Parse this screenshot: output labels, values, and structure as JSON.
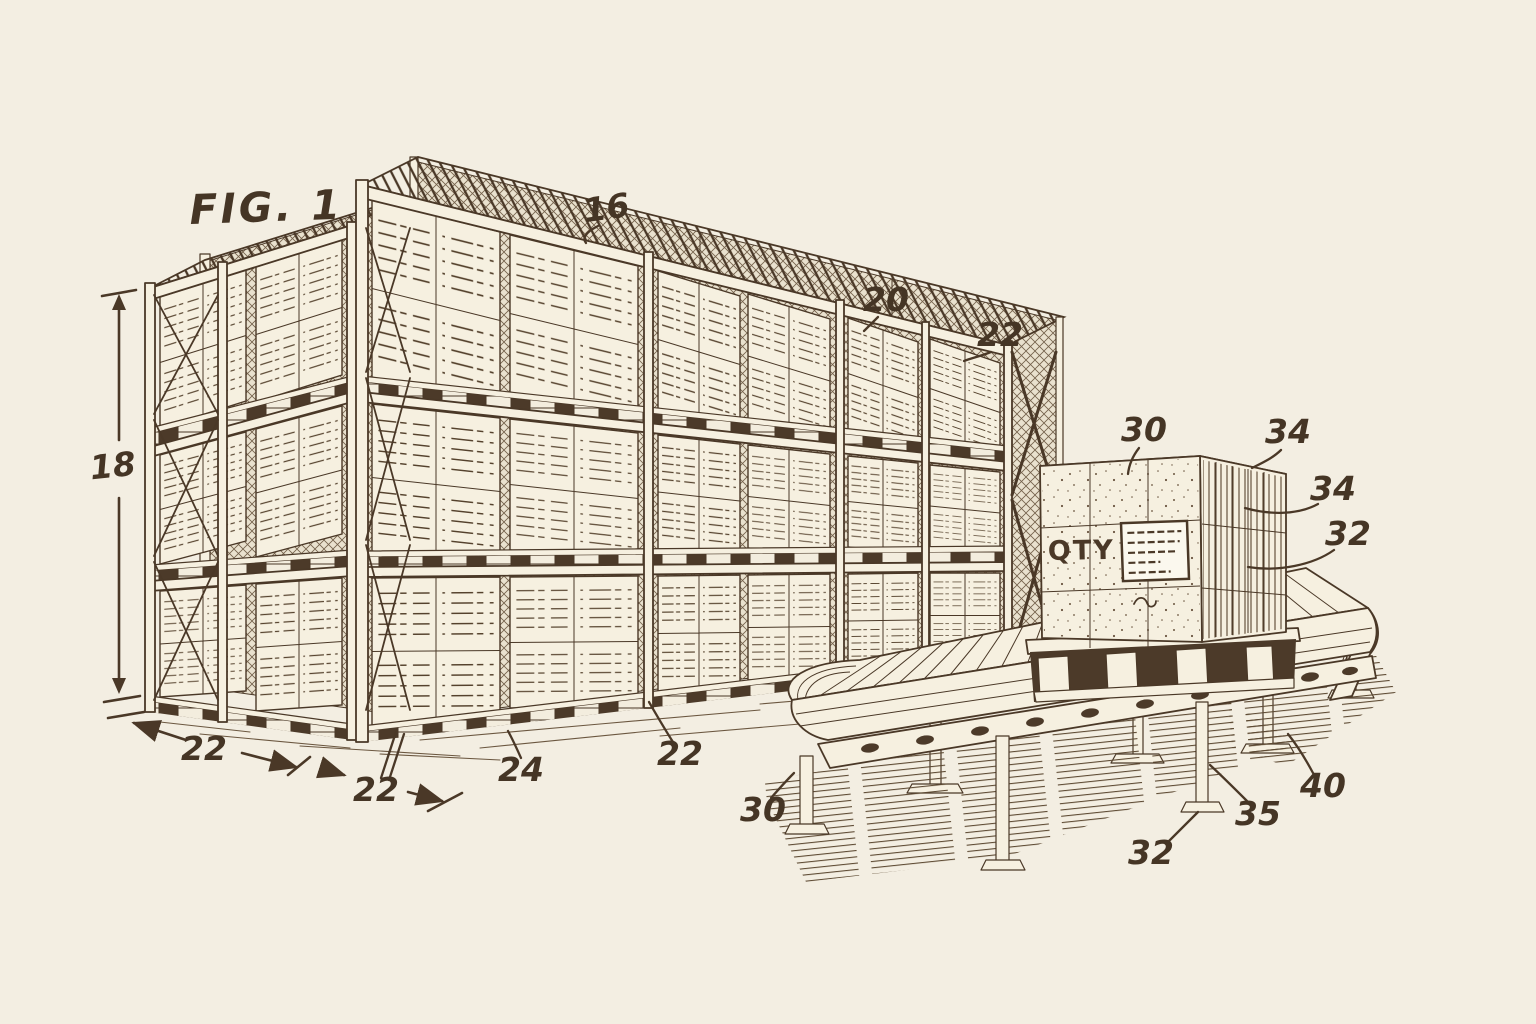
{
  "figure": {
    "title": "FIG. 1",
    "callouts": [
      {
        "text": "16",
        "x": 608,
        "y": 219,
        "rot": -8
      },
      {
        "text": "20",
        "x": 886,
        "y": 311,
        "rot": 0
      },
      {
        "text": "22",
        "x": 1000,
        "y": 346,
        "rot": 0
      },
      {
        "text": "18",
        "x": 114,
        "y": 477,
        "rot": -6
      },
      {
        "text": "22",
        "x": 204,
        "y": 760,
        "rot": 0
      },
      {
        "text": "22",
        "x": 376,
        "y": 801,
        "rot": 0
      },
      {
        "text": "24",
        "x": 521,
        "y": 781,
        "rot": 0
      },
      {
        "text": "22",
        "x": 680,
        "y": 765,
        "rot": 0
      },
      {
        "text": "30",
        "x": 763,
        "y": 821,
        "rot": 0
      },
      {
        "text": "30",
        "x": 1144,
        "y": 441,
        "rot": 0
      },
      {
        "text": "34",
        "x": 1288,
        "y": 443,
        "rot": 0
      },
      {
        "text": "34",
        "x": 1333,
        "y": 500,
        "rot": 0
      },
      {
        "text": "32",
        "x": 1348,
        "y": 545,
        "rot": 0
      },
      {
        "text": "40",
        "x": 1323,
        "y": 797,
        "rot": 0
      },
      {
        "text": "35",
        "x": 1258,
        "y": 825,
        "rot": 0
      },
      {
        "text": "32",
        "x": 1151,
        "y": 864,
        "rot": 0
      }
    ],
    "colors": {
      "background": "#f3eee2",
      "ink": "#4a3827",
      "ink_soft": "#6b5740",
      "paper": "#f6f0e0",
      "shadow": "#4c3a29",
      "label_paper": "#fbf8ee"
    }
  },
  "box": {
    "marking": "QTY",
    "label_ruled_lines": 5
  }
}
